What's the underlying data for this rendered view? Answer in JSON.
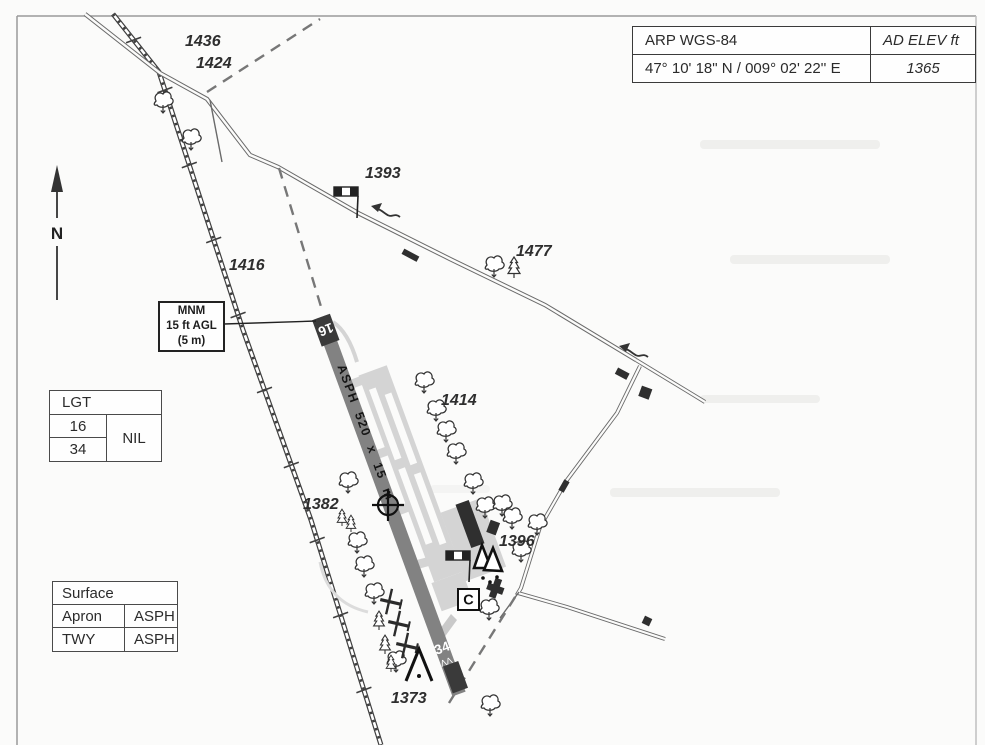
{
  "page": {
    "background": "#fbfbfa",
    "frame_color": "#9a9a9a"
  },
  "info_table": {
    "arp_label": "ARP WGS-84",
    "elev_header": "AD ELEV ft",
    "arp_coordinates": "47° 10' 18\" N / 009° 02' 22'' E",
    "elevation_ft": "1365"
  },
  "north_indicator": {
    "label": "N"
  },
  "mnm_box": {
    "line1": "MNM",
    "line2": "15 ft AGL",
    "line3": "(5 m)"
  },
  "lgt_table": {
    "header": "LGT",
    "row1": "16",
    "row2": "34",
    "value": "NIL"
  },
  "surface_table": {
    "header": "Surface",
    "row1_name": "Apron",
    "row1_value": "ASPH",
    "row2_name": "TWY",
    "row2_value": "ASPH"
  },
  "runway": {
    "rwy16": "16",
    "rwy34": "34",
    "surface_dimensions": "ASPH 520 x 15 m",
    "threshold_marks": "ΛΛ"
  },
  "spot_elevations": [
    "1436",
    "1424",
    "1393",
    "1477",
    "1416",
    "1414",
    "1382",
    "1396",
    "1373"
  ],
  "signs": {
    "c_office": "C"
  },
  "colors": {
    "runway": "#828282",
    "runway_end": "#3a3a3a",
    "apron": "#d4d4d4",
    "building": "#2f2f2f",
    "dashed_line": "#777777"
  }
}
